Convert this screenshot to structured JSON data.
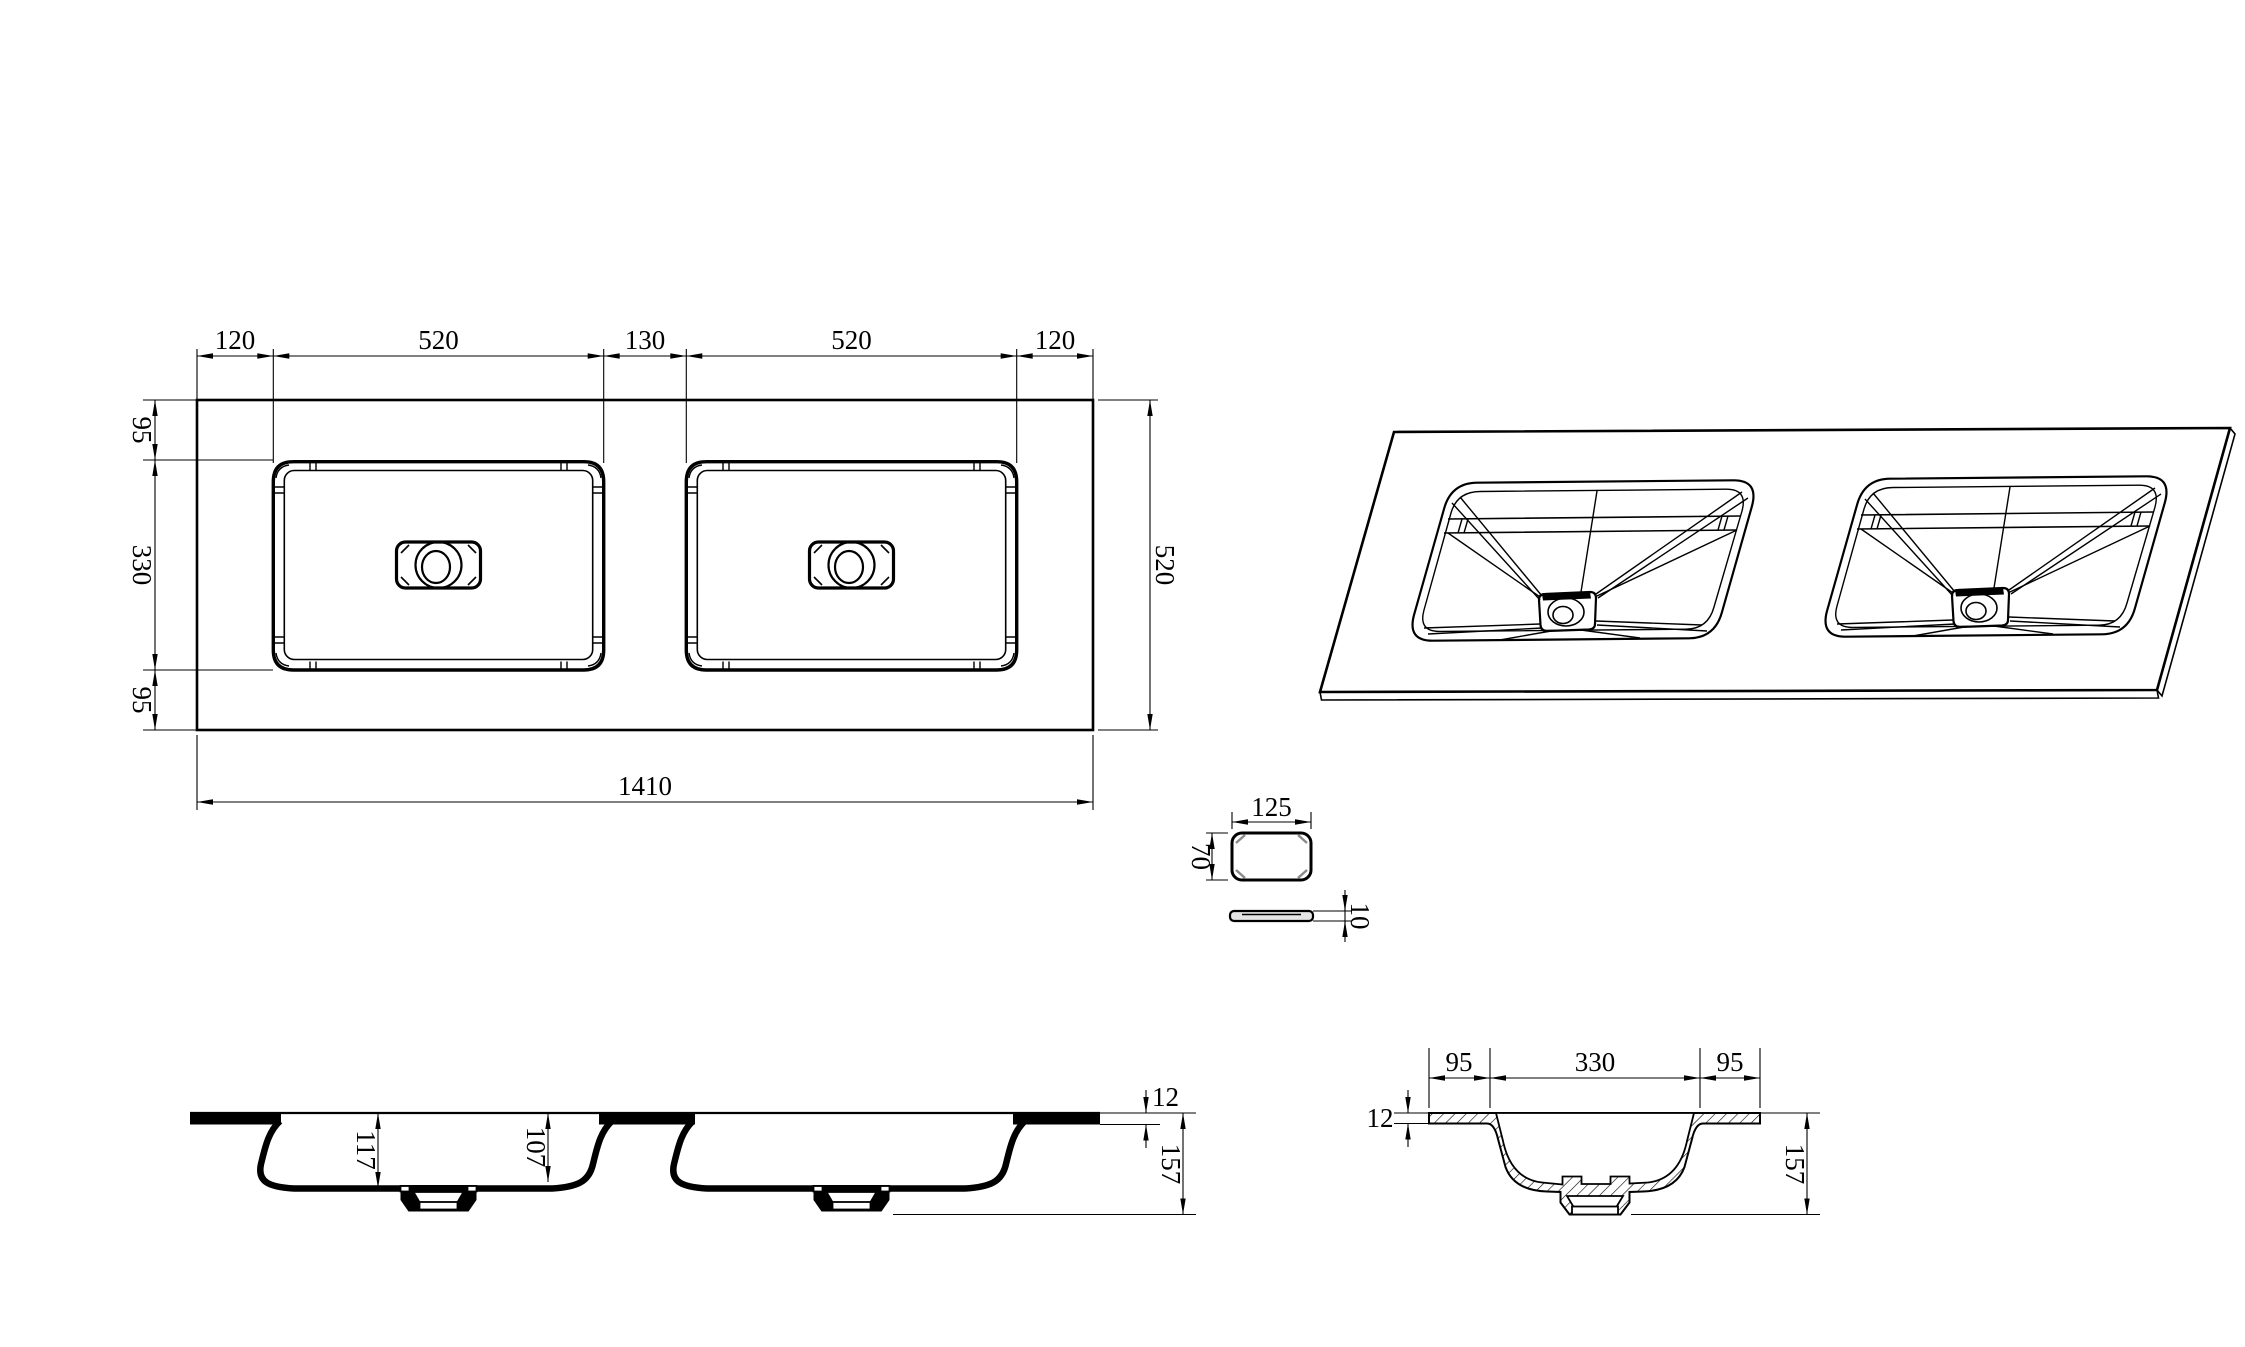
{
  "drawing_title": "double-basin-vanity-top-technical-drawing",
  "colors": {
    "line": "#000000",
    "background": "#ffffff",
    "chamfer_gray": "#8a8a8a"
  },
  "plan": {
    "dims_top": [
      "120",
      "520",
      "130",
      "520",
      "120"
    ],
    "dims_left": [
      "95",
      "330",
      "95"
    ],
    "dim_bottom": "1410",
    "dim_right": "520"
  },
  "detail": {
    "dim_width": "125",
    "dim_height": "70",
    "dim_thickness": "10"
  },
  "section_long": {
    "dim_depth_at_drain": "117",
    "dim_depth_at_wall": "107",
    "dim_top_thickness": "12",
    "dim_total_height": "157"
  },
  "section_cross": {
    "dims_top": [
      "95",
      "330",
      "95"
    ],
    "dim_top_thickness": "12",
    "dim_total_height": "157"
  }
}
